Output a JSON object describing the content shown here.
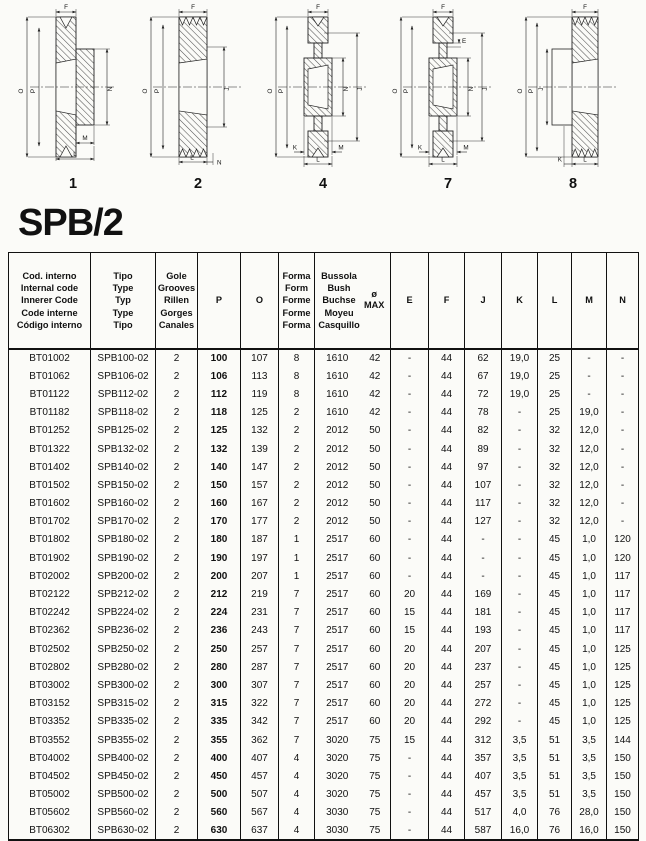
{
  "page": {
    "title": "SPB/2"
  },
  "diagrams": [
    {
      "number": "1",
      "letters": [
        "F",
        "O",
        "P",
        "N",
        "M",
        "L"
      ]
    },
    {
      "number": "2",
      "letters": [
        "F",
        "O",
        "P",
        "J",
        "L",
        "N"
      ]
    },
    {
      "number": "4",
      "letters": [
        "F",
        "O",
        "P",
        "N",
        "J",
        "K",
        "M",
        "L"
      ]
    },
    {
      "number": "7",
      "letters": [
        "F",
        "E",
        "O",
        "P",
        "N",
        "J",
        "K",
        "M",
        "L"
      ]
    },
    {
      "number": "8",
      "letters": [
        "F",
        "O",
        "P",
        "J",
        "K",
        "L"
      ]
    }
  ],
  "table": {
    "headers": {
      "code": "Cod. interno\nInternal code\nInnerer Code\nCode interne\nCódigo interno",
      "type": "Tipo\nType\nTyp\nType\nTipo",
      "grooves": "Gole\nGrooves\nRillen\nGorges\nCanales",
      "p": "P",
      "o": "O",
      "form": "Forma\nForm\nForme\nForme\nForma",
      "bush": "Bussola\nBush\nBuchse\nMoyeu\nCasquillo",
      "bush_max": "ø MAX",
      "e": "E",
      "f": "F",
      "j": "J",
      "k": "K",
      "l": "L",
      "m": "M",
      "n": "N"
    },
    "rows": [
      [
        "BT01002",
        "SPB100-02",
        "2",
        "100",
        "107",
        "8",
        "1610",
        "42",
        "-",
        "44",
        "62",
        "19,0",
        "25",
        "-",
        "-"
      ],
      [
        "BT01062",
        "SPB106-02",
        "2",
        "106",
        "113",
        "8",
        "1610",
        "42",
        "-",
        "44",
        "67",
        "19,0",
        "25",
        "-",
        "-"
      ],
      [
        "BT01122",
        "SPB112-02",
        "2",
        "112",
        "119",
        "8",
        "1610",
        "42",
        "-",
        "44",
        "72",
        "19,0",
        "25",
        "-",
        "-"
      ],
      [
        "BT01182",
        "SPB118-02",
        "2",
        "118",
        "125",
        "2",
        "1610",
        "42",
        "-",
        "44",
        "78",
        "-",
        "25",
        "19,0",
        "-"
      ],
      [
        "BT01252",
        "SPB125-02",
        "2",
        "125",
        "132",
        "2",
        "2012",
        "50",
        "-",
        "44",
        "82",
        "-",
        "32",
        "12,0",
        "-"
      ],
      [
        "BT01322",
        "SPB132-02",
        "2",
        "132",
        "139",
        "2",
        "2012",
        "50",
        "-",
        "44",
        "89",
        "-",
        "32",
        "12,0",
        "-"
      ],
      [
        "BT01402",
        "SPB140-02",
        "2",
        "140",
        "147",
        "2",
        "2012",
        "50",
        "-",
        "44",
        "97",
        "-",
        "32",
        "12,0",
        "-"
      ],
      [
        "BT01502",
        "SPB150-02",
        "2",
        "150",
        "157",
        "2",
        "2012",
        "50",
        "-",
        "44",
        "107",
        "-",
        "32",
        "12,0",
        "-"
      ],
      [
        "BT01602",
        "SPB160-02",
        "2",
        "160",
        "167",
        "2",
        "2012",
        "50",
        "-",
        "44",
        "117",
        "-",
        "32",
        "12,0",
        "-"
      ],
      [
        "BT01702",
        "SPB170-02",
        "2",
        "170",
        "177",
        "2",
        "2012",
        "50",
        "-",
        "44",
        "127",
        "-",
        "32",
        "12,0",
        "-"
      ],
      [
        "BT01802",
        "SPB180-02",
        "2",
        "180",
        "187",
        "1",
        "2517",
        "60",
        "-",
        "44",
        "-",
        "-",
        "45",
        "1,0",
        "120"
      ],
      [
        "BT01902",
        "SPB190-02",
        "2",
        "190",
        "197",
        "1",
        "2517",
        "60",
        "-",
        "44",
        "-",
        "-",
        "45",
        "1,0",
        "120"
      ],
      [
        "BT02002",
        "SPB200-02",
        "2",
        "200",
        "207",
        "1",
        "2517",
        "60",
        "-",
        "44",
        "-",
        "-",
        "45",
        "1,0",
        "117"
      ],
      [
        "BT02122",
        "SPB212-02",
        "2",
        "212",
        "219",
        "7",
        "2517",
        "60",
        "20",
        "44",
        "169",
        "-",
        "45",
        "1,0",
        "117"
      ],
      [
        "BT02242",
        "SPB224-02",
        "2",
        "224",
        "231",
        "7",
        "2517",
        "60",
        "15",
        "44",
        "181",
        "-",
        "45",
        "1,0",
        "117"
      ],
      [
        "BT02362",
        "SPB236-02",
        "2",
        "236",
        "243",
        "7",
        "2517",
        "60",
        "15",
        "44",
        "193",
        "-",
        "45",
        "1,0",
        "117"
      ],
      [
        "BT02502",
        "SPB250-02",
        "2",
        "250",
        "257",
        "7",
        "2517",
        "60",
        "20",
        "44",
        "207",
        "-",
        "45",
        "1,0",
        "125"
      ],
      [
        "BT02802",
        "SPB280-02",
        "2",
        "280",
        "287",
        "7",
        "2517",
        "60",
        "20",
        "44",
        "237",
        "-",
        "45",
        "1,0",
        "125"
      ],
      [
        "BT03002",
        "SPB300-02",
        "2",
        "300",
        "307",
        "7",
        "2517",
        "60",
        "20",
        "44",
        "257",
        "-",
        "45",
        "1,0",
        "125"
      ],
      [
        "BT03152",
        "SPB315-02",
        "2",
        "315",
        "322",
        "7",
        "2517",
        "60",
        "20",
        "44",
        "272",
        "-",
        "45",
        "1,0",
        "125"
      ],
      [
        "BT03352",
        "SPB335-02",
        "2",
        "335",
        "342",
        "7",
        "2517",
        "60",
        "20",
        "44",
        "292",
        "-",
        "45",
        "1,0",
        "125"
      ],
      [
        "BT03552",
        "SPB355-02",
        "2",
        "355",
        "362",
        "7",
        "3020",
        "75",
        "15",
        "44",
        "312",
        "3,5",
        "51",
        "3,5",
        "144"
      ],
      [
        "BT04002",
        "SPB400-02",
        "2",
        "400",
        "407",
        "4",
        "3020",
        "75",
        "-",
        "44",
        "357",
        "3,5",
        "51",
        "3,5",
        "150"
      ],
      [
        "BT04502",
        "SPB450-02",
        "2",
        "450",
        "457",
        "4",
        "3020",
        "75",
        "-",
        "44",
        "407",
        "3,5",
        "51",
        "3,5",
        "150"
      ],
      [
        "BT05002",
        "SPB500-02",
        "2",
        "500",
        "507",
        "4",
        "3020",
        "75",
        "-",
        "44",
        "457",
        "3,5",
        "51",
        "3,5",
        "150"
      ],
      [
        "BT05602",
        "SPB560-02",
        "2",
        "560",
        "567",
        "4",
        "3030",
        "75",
        "-",
        "44",
        "517",
        "4,0",
        "76",
        "28,0",
        "150"
      ],
      [
        "BT06302",
        "SPB630-02",
        "2",
        "630",
        "637",
        "4",
        "3030",
        "75",
        "-",
        "44",
        "587",
        "16,0",
        "76",
        "16,0",
        "150"
      ]
    ]
  }
}
